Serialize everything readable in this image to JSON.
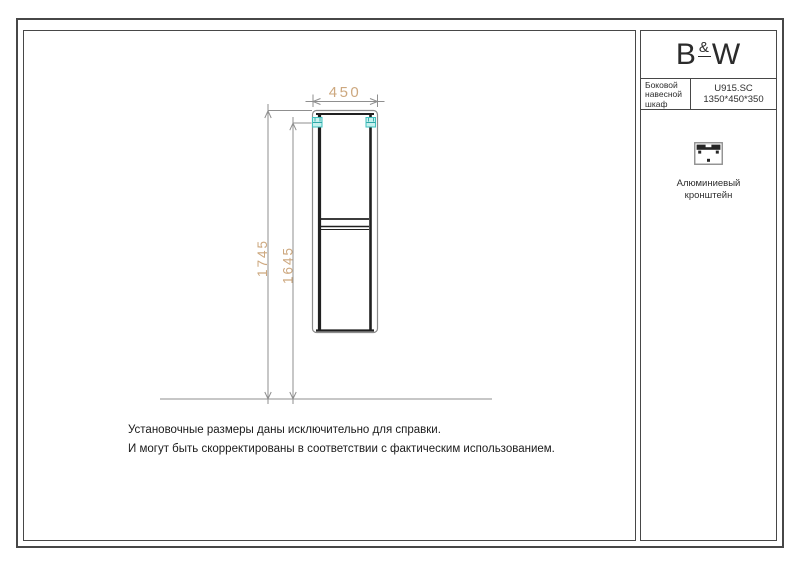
{
  "title_block": {
    "logo": {
      "b": "B",
      "amp": "&",
      "w": "W"
    },
    "product_name": "Боковой навесной шкаф",
    "product_code": "U915.SC",
    "product_size": "1350*450*350",
    "accessory_label": "Алюминиевый кронштейн",
    "accessory_icon": "aluminum-bracket-icon"
  },
  "dimensions": {
    "width": "450",
    "height_total": "1745",
    "height_bracket": "1645"
  },
  "notes": {
    "line1": "Установочные размеры даны исключительно для справки.",
    "line2": "И могут быть скорректированы в соответствии с фактическим использованием."
  },
  "colors": {
    "dim_text": "#cda87f",
    "line_gray": "#8f8f8f",
    "cabinet_dark": "#202020",
    "bracket_fill": "#c6f1ee",
    "bracket_stroke": "#3ec0be",
    "frame_border": "#474747"
  },
  "icons": {
    "wall_marker": "wall-bracket-marker-icon",
    "accessory": "aluminum-bracket-icon"
  }
}
